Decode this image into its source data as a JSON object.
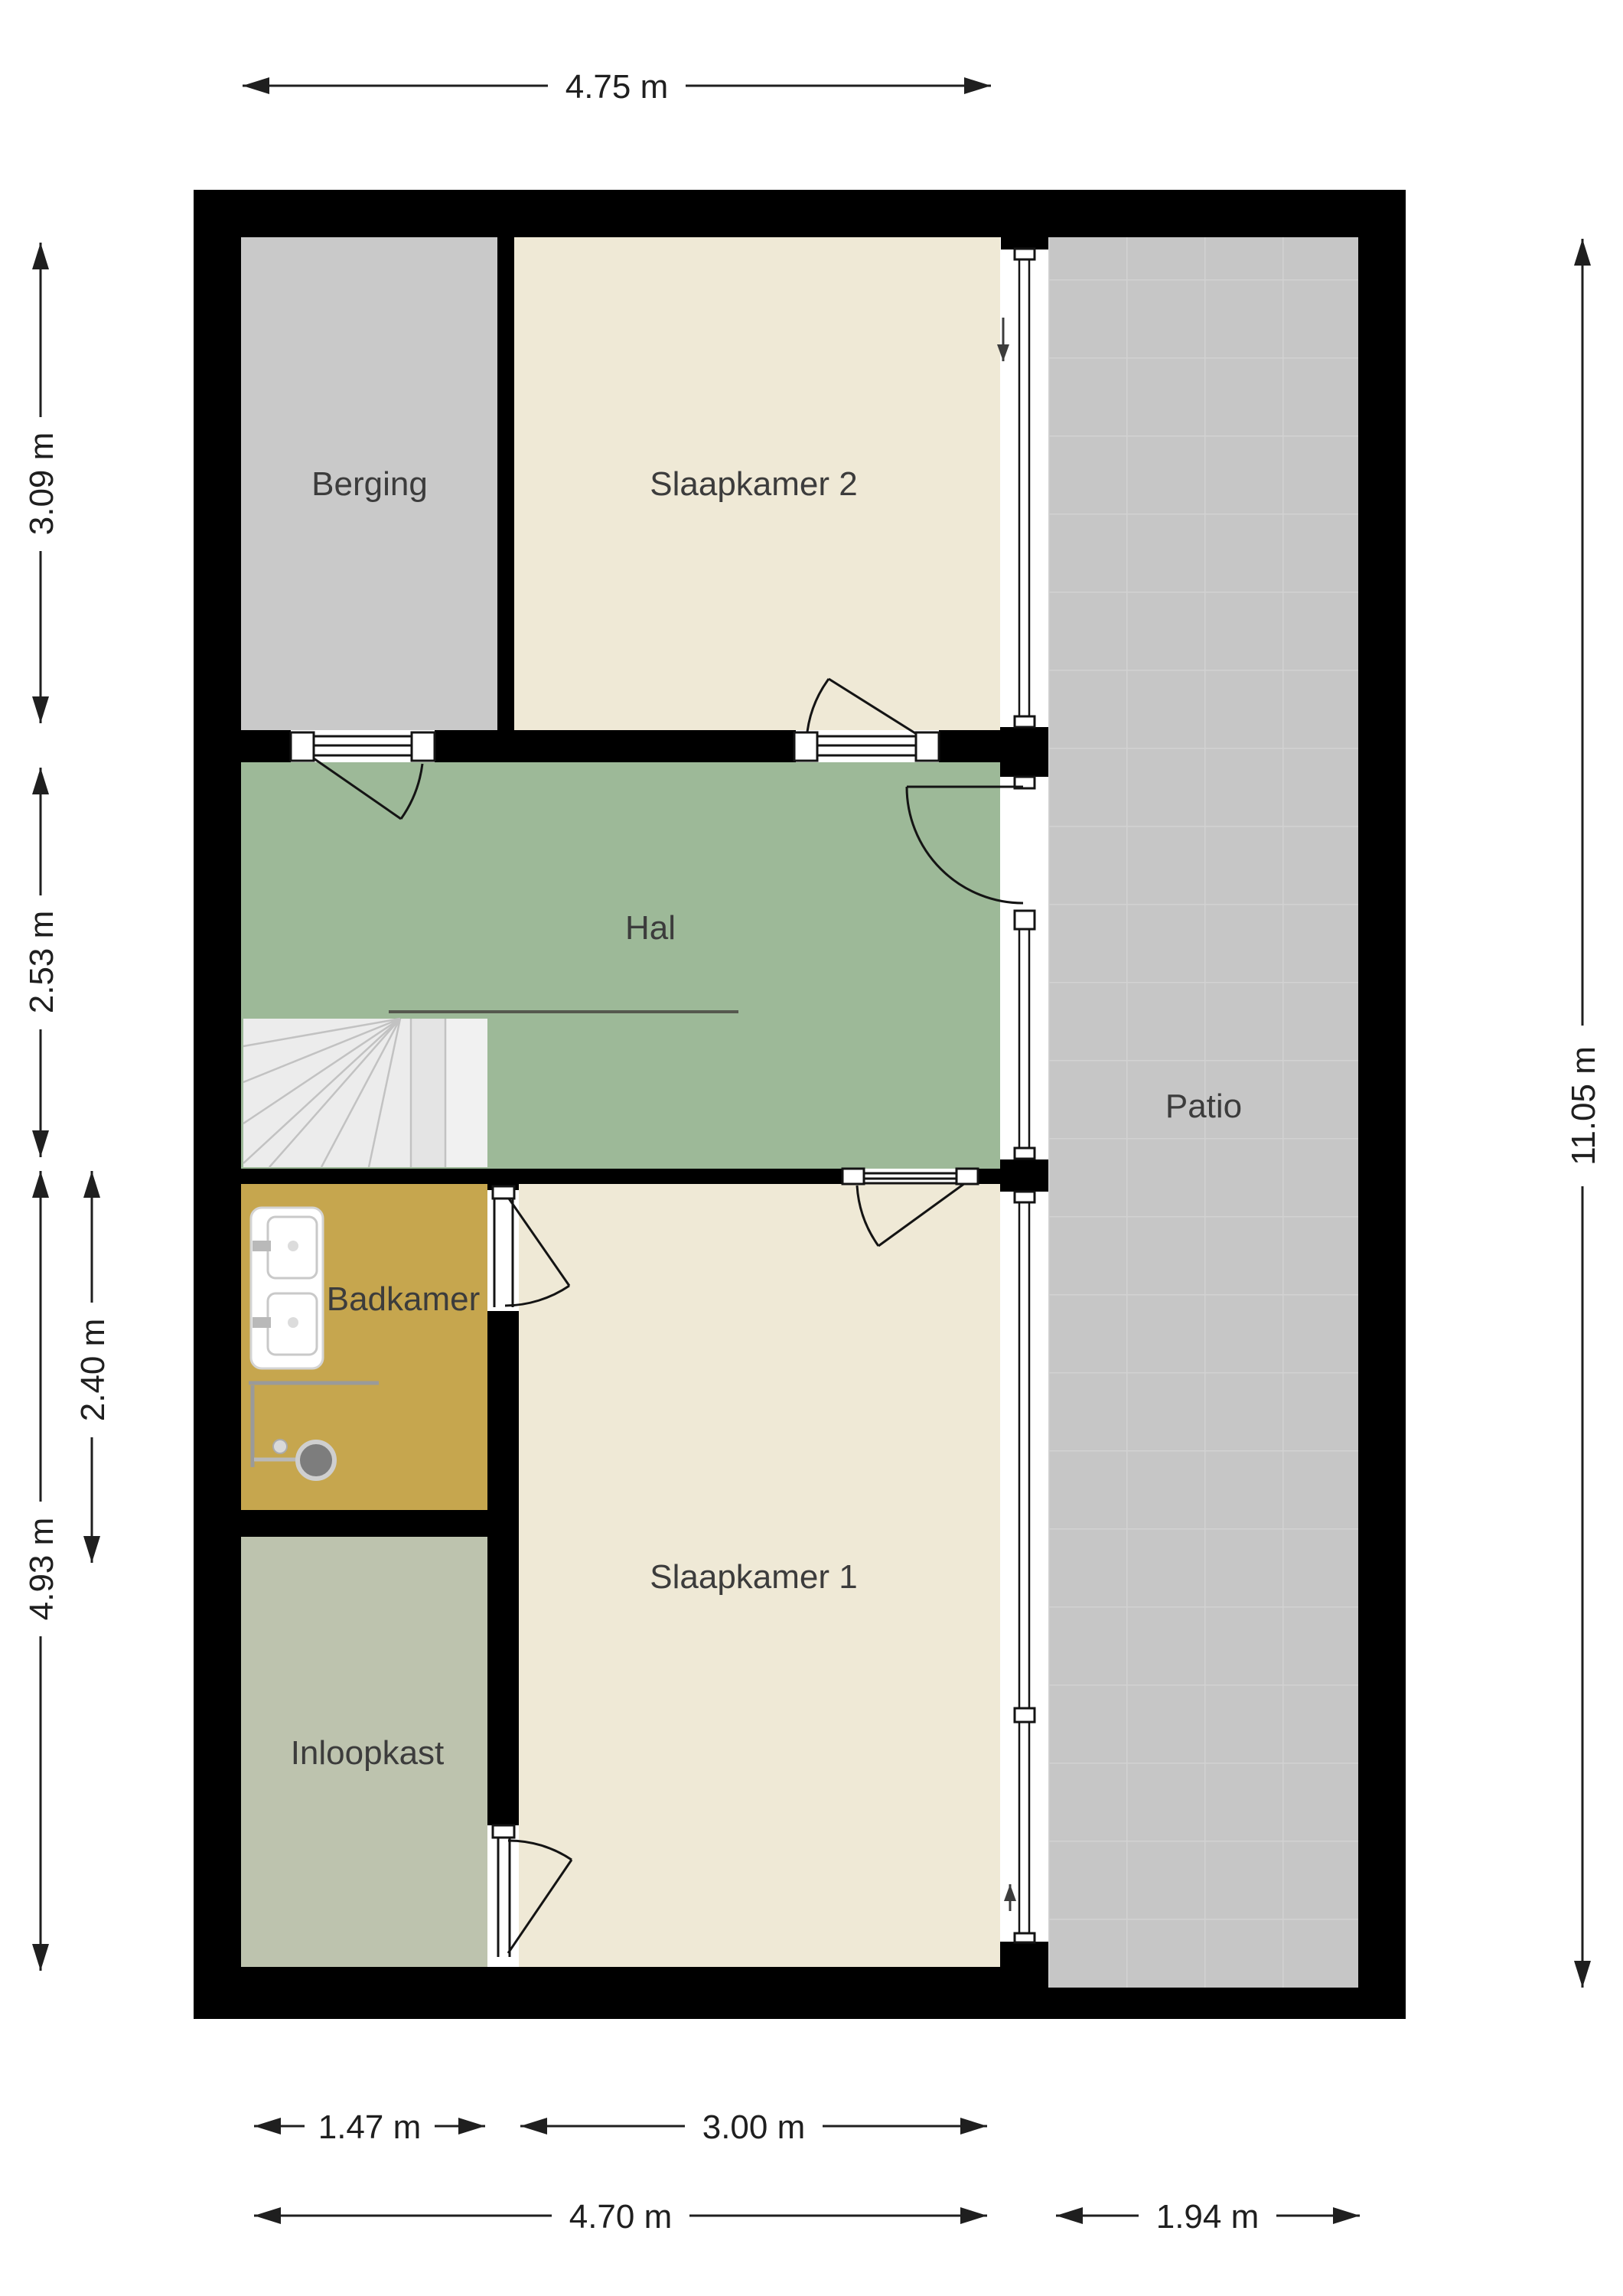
{
  "plan": {
    "title": "floor-plan",
    "rooms": [
      {
        "name": "berging",
        "label": "Berging",
        "color": "#c9c9c9"
      },
      {
        "name": "slaapkamer-2",
        "label": "Slaapkamer 2",
        "color": "#efe9d6"
      },
      {
        "name": "hal",
        "label": "Hal",
        "color": "#9db998"
      },
      {
        "name": "badkamer",
        "label": "Badkamer",
        "color": "#c6a64e"
      },
      {
        "name": "slaapkamer-1",
        "label": "Slaapkamer 1",
        "color": "#efe9d6"
      },
      {
        "name": "inloopkast",
        "label": "Inloopkast",
        "color": "#bdc3ae"
      },
      {
        "name": "patio",
        "label": "Patio",
        "color": "#c6c6c6"
      }
    ],
    "dimensions": {
      "top_width": "4.75 m",
      "right_height": "11.05 m",
      "left_top": "3.09 m",
      "left_middle": "2.53 m",
      "left_bottom_total": "4.93 m",
      "left_badkamer": "2.40 m",
      "bottom_inloopkast": "1.47 m",
      "bottom_slaapkamer1": "3.00 m",
      "bottom_total": "4.70 m",
      "bottom_patio": "1.94 m"
    },
    "icons": {
      "entry_arrow_top": "arrow-down",
      "entry_arrow_bottom": "arrow-up"
    },
    "colors": {
      "wall": "#000000",
      "background": "#ffffff",
      "text": "#3c3c3c",
      "dimension": "#1f1f1f",
      "stairs": "#ececec",
      "stair_line": "#c2c2c2",
      "handrail": "#55584e",
      "glazing": "#141414",
      "door_line": "#141414",
      "patio_grout": "#d2d2d2",
      "fixture_white": "#ffffff",
      "fixture_outline": "#c9c9c9",
      "shower_line": "#9a9a9a",
      "shower_head": "#7d7d7d"
    }
  }
}
